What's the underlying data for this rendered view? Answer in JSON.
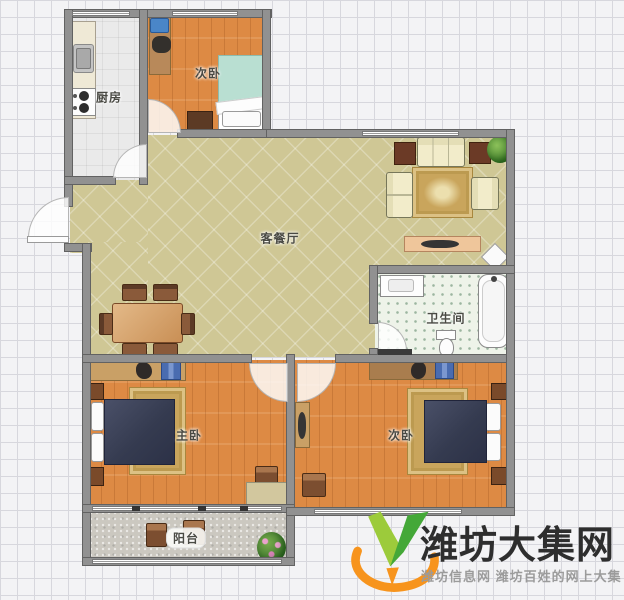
{
  "floorplan": {
    "rooms": {
      "kitchen": {
        "label": "厨房"
      },
      "bedroom_top": {
        "label": "次卧"
      },
      "living_dining": {
        "label": "客餐厅"
      },
      "bathroom": {
        "label": "卫生间"
      },
      "master_bedroom": {
        "label": "主卧"
      },
      "bedroom_second": {
        "label": "次卧"
      },
      "balcony": {
        "label": "阳台"
      }
    },
    "palette": {
      "wall": "#919191",
      "living_floor": "#cfc795",
      "wood_floor": "#dd8a44",
      "kitchen_floor": "#eaeaea",
      "bath_floor": "#eef3e9",
      "balcony_floor": "#cbc8c0",
      "rug": "#c9a55c",
      "bed": "#353b50",
      "sofa": "#f2ecca"
    }
  },
  "watermark": {
    "site_name": "潍坊大集网",
    "tagline": "潍坊信息网 潍坊百姓的网上大集",
    "brand_green": "#6cbf3a",
    "brand_orange": "#f7941d"
  }
}
